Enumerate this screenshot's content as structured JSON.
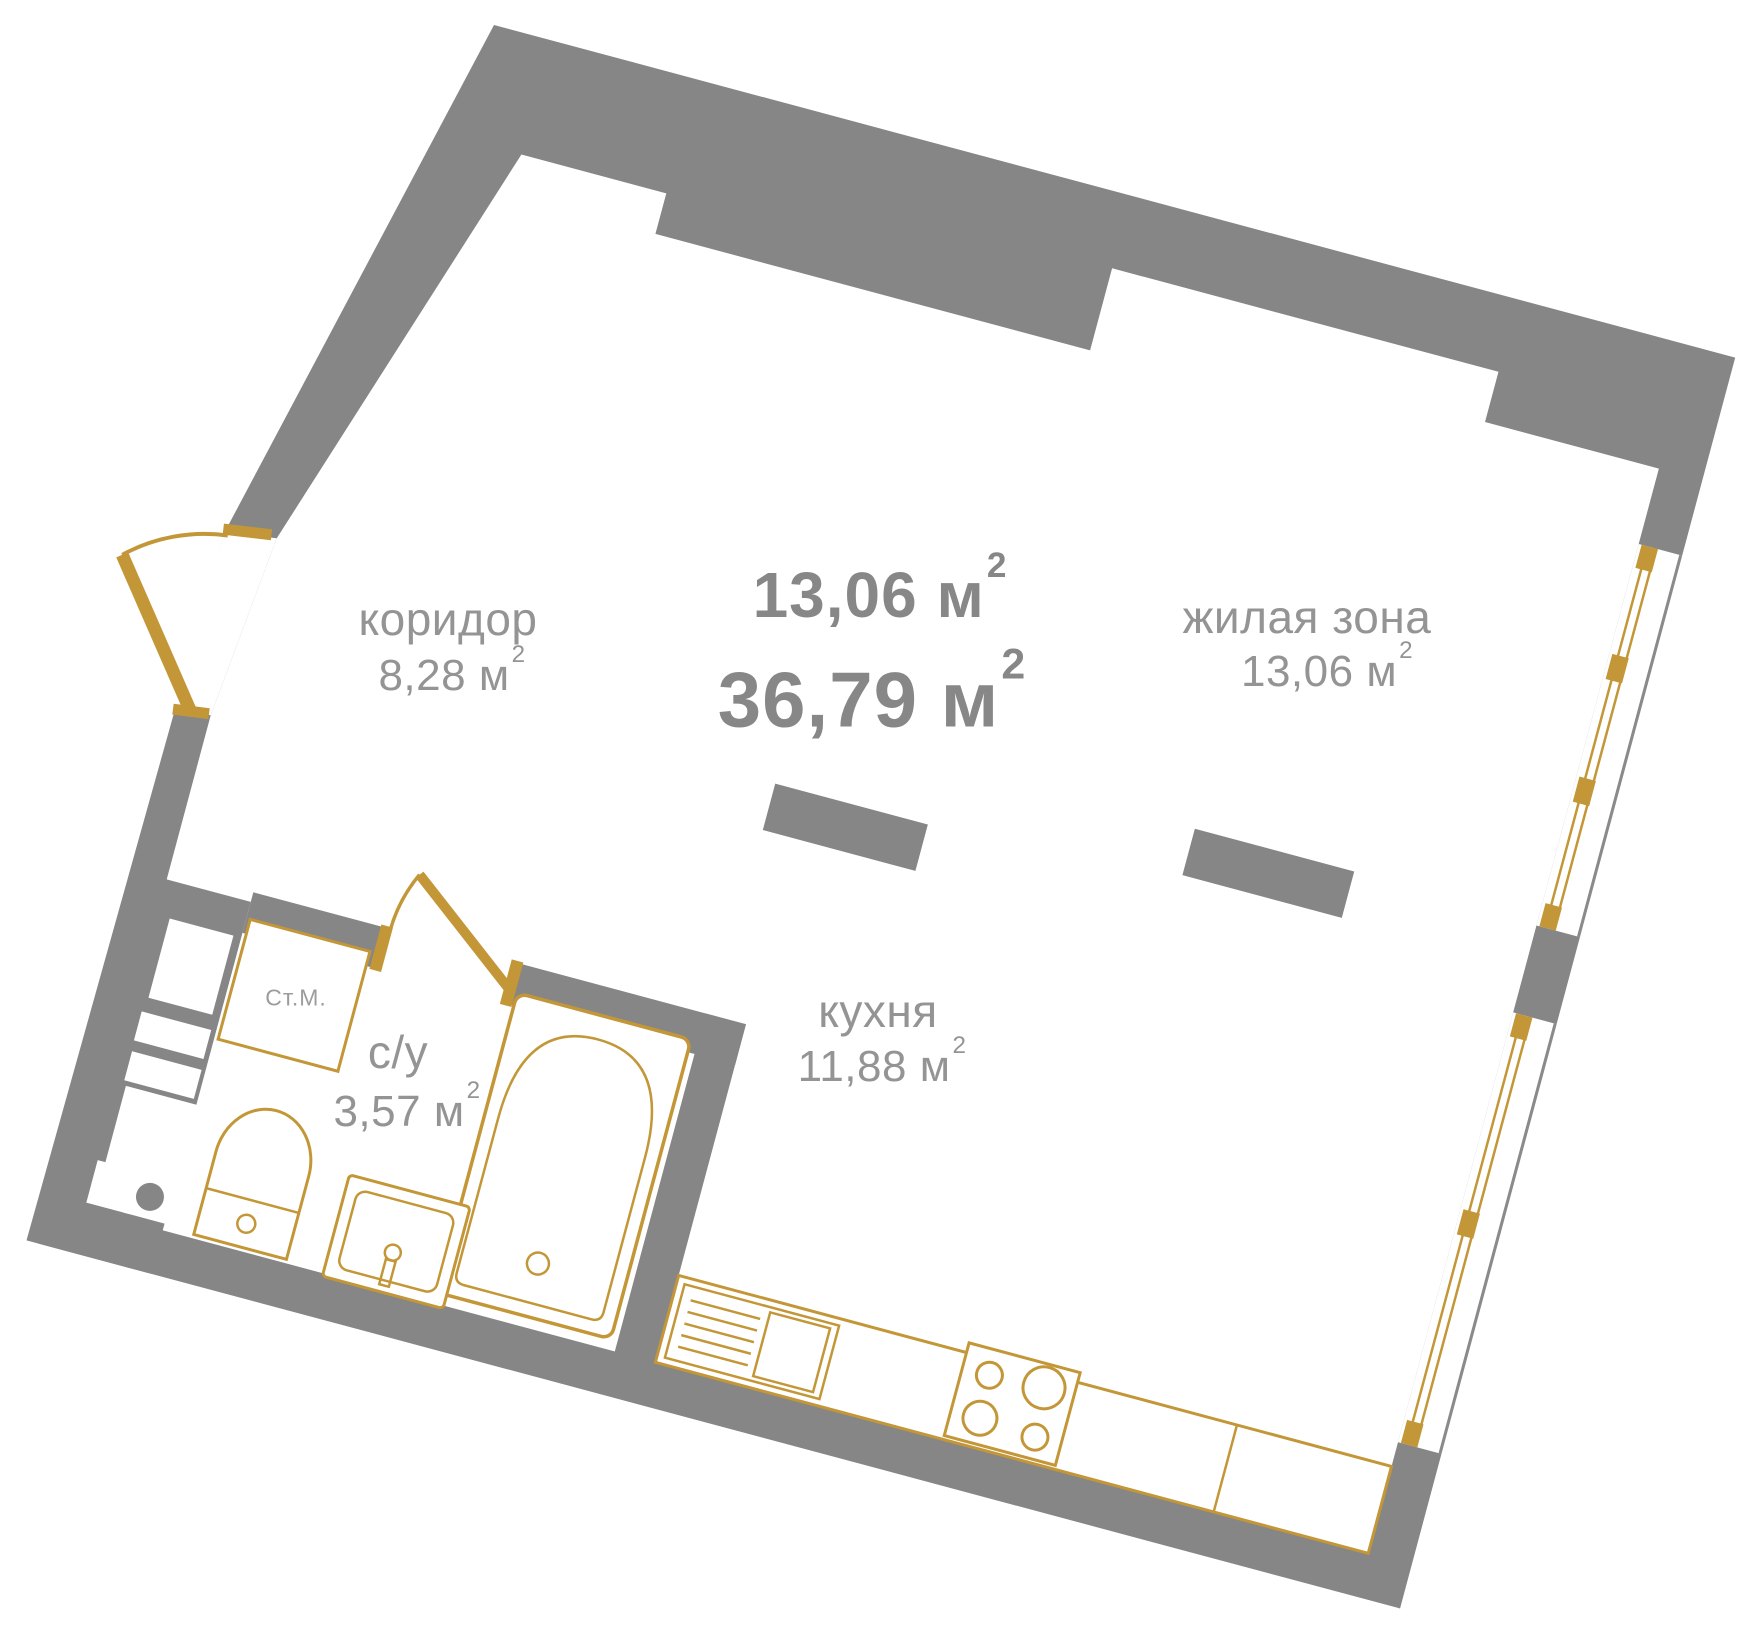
{
  "title": "apartment floor plan",
  "areas": {
    "primary": "13,06",
    "total": "36,79"
  },
  "unit": {
    "symbol": "м",
    "exp": "2"
  },
  "rooms": [
    {
      "id": "corridor",
      "name": "коридор",
      "area": "8,28"
    },
    {
      "id": "living",
      "name": "жилая зона",
      "area": "13,06"
    },
    {
      "id": "kitchen",
      "name": "кухня",
      "area": "11,88"
    },
    {
      "id": "bathroom",
      "name": "с/у",
      "area": "3,57"
    }
  ],
  "appliances": {
    "washing_machine": "Ст.М."
  },
  "colors": {
    "wall": "#868686",
    "accent_gold": "#c39738",
    "label": "#949494",
    "bold_label": "#878787",
    "floor": "#ffffff"
  }
}
